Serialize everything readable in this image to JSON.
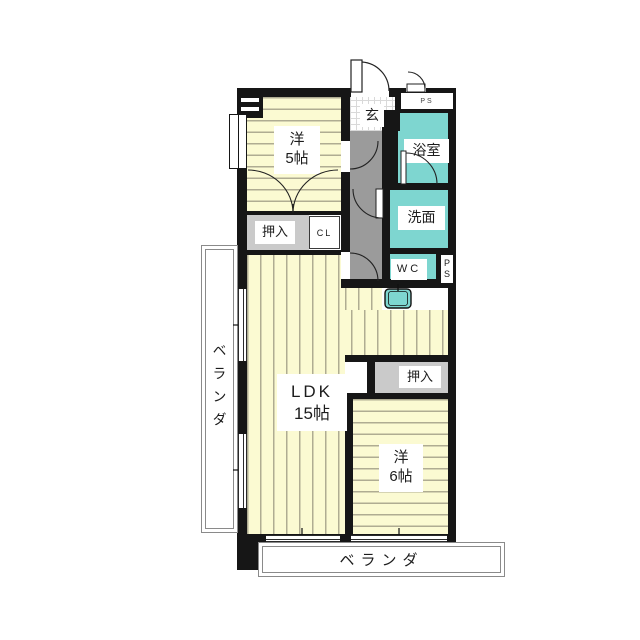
{
  "colors": {
    "wall": "#161616",
    "tatami": "#FBFAD2",
    "stripe": "#AFAC92",
    "wet": "#7ED6D0",
    "hall": "#9B9B9B",
    "closet": "#CACACA"
  },
  "rooms": {
    "yo5": {
      "l1": "洋",
      "l2": "5帖"
    },
    "genkan": {
      "label": "玄"
    },
    "ps_top": {
      "label": "PS"
    },
    "bath": {
      "label": "浴室"
    },
    "wash": {
      "label": "洗面"
    },
    "wc": {
      "label": "WC"
    },
    "ps_side": {
      "l1": "P",
      "l2": "S"
    },
    "oshiire_top": {
      "label": "押入"
    },
    "cl": {
      "label": "CL"
    },
    "ldk": {
      "l1": "LDK",
      "l2": "15帖"
    },
    "oshiire_right": {
      "label": "押入"
    },
    "yo6": {
      "l1": "洋",
      "l2": "6帖"
    },
    "veranda_left": {
      "label": "ベランダ"
    },
    "veranda_bottom": {
      "label": "ベランダ"
    }
  }
}
